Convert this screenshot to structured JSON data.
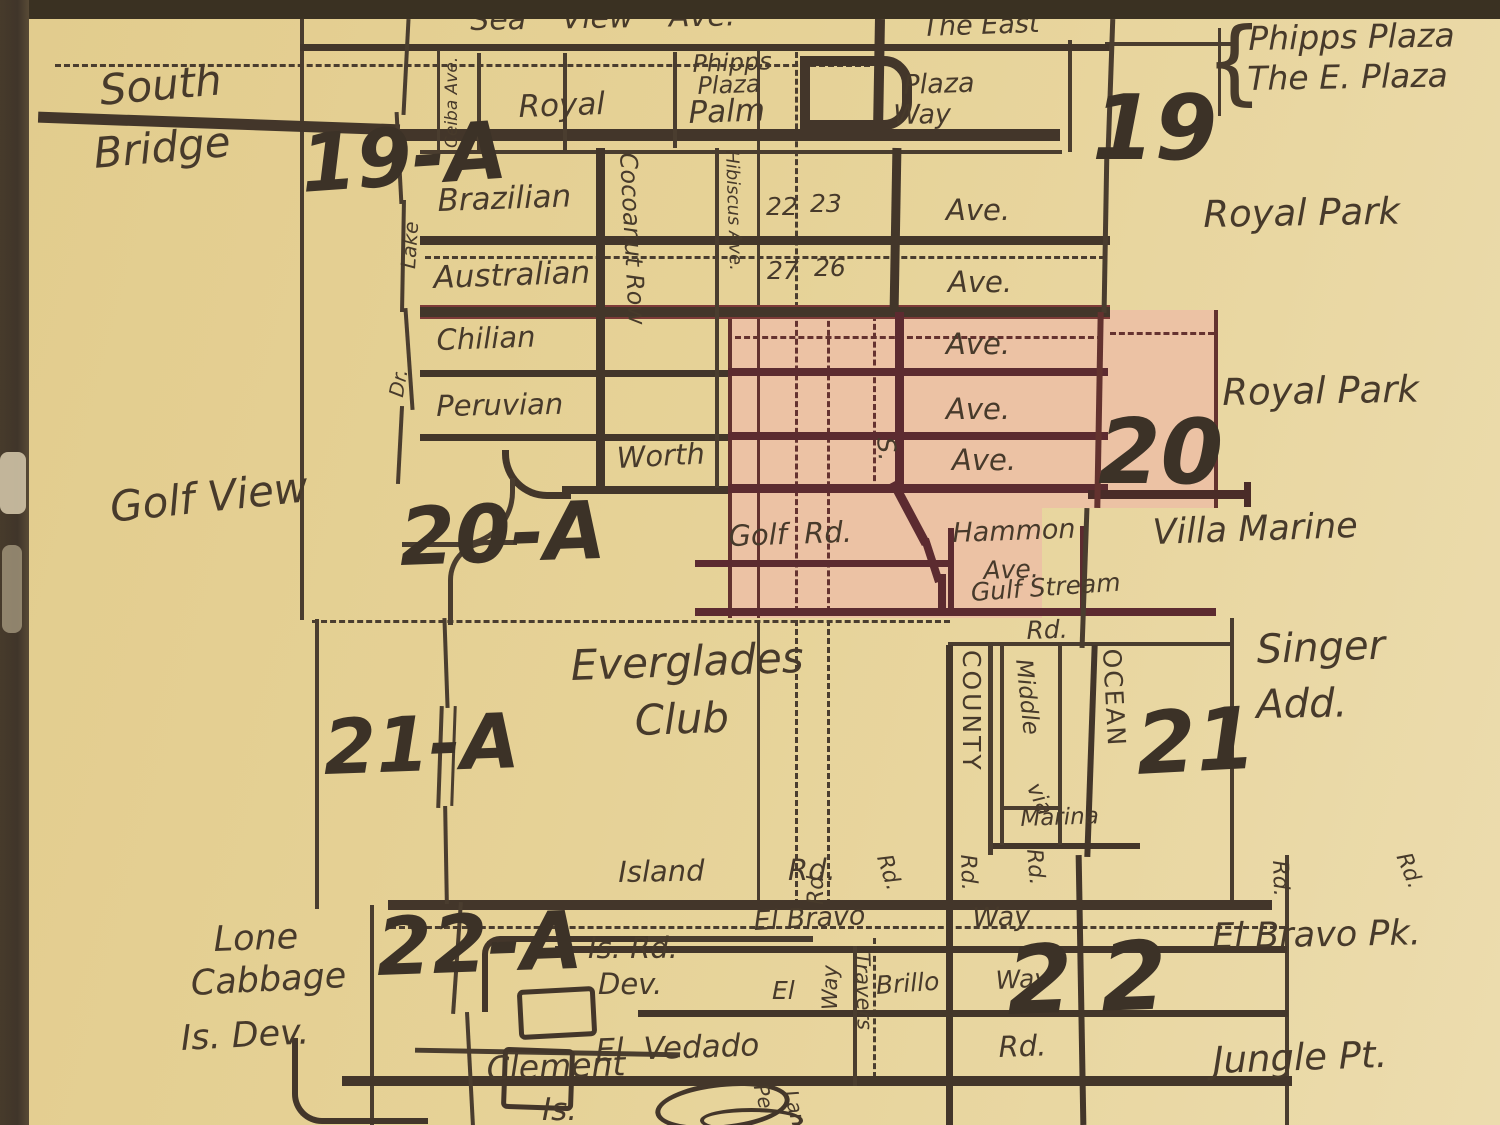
{
  "map_title": "Palm Beach plat map (Royal Park / Everglades Club district)",
  "colors": {
    "paper": "#e6d297",
    "ink": "#43362a",
    "highlight_pink": "#ecc2a4",
    "highlight_road_maroon": "#5c2b30",
    "frame": "#3a3122"
  },
  "labels": {
    "sea_view": "Sea View Ave.",
    "the_east": "The East",
    "brace": "{",
    "phipps_plaza_r1": "Phipps Plaza",
    "phipps_plaza_r2": "The E. Plaza",
    "south": "South",
    "bridge": "Bridge",
    "p19a": "19-A",
    "p19": "19",
    "royal": "Royal",
    "palm": "Palm",
    "phipps_sm1": "Phipps",
    "phipps_sm2": "Plaza",
    "plaza": "Plaza",
    "way": "Way",
    "ceiba": "Ceiba Ave.",
    "lake": "Lake",
    "dr": "Dr.",
    "brazilian": "Brazilian",
    "n22": "22",
    "n23": "23",
    "ave_braz": "Ave.",
    "australian": "Australian",
    "n27": "27",
    "n26": "26",
    "ave_aus": "Ave.",
    "chilian": "Chilian",
    "ave_chi": "Ave.",
    "peruvian": "Peruvian",
    "ave_per": "Ave.",
    "worth": "Worth",
    "s_cnty": "S.",
    "ave_worth": "Ave.",
    "p20": "20",
    "royal_park1": "Royal Park",
    "royal_park2": "Royal Park",
    "cocoanut": "Cocoanut Row",
    "hibiscus": "Hibiscus Ave.",
    "golf_view": "Golf View",
    "p20a": "20-A",
    "golf_rd": "Golf Rd.",
    "hammon": "Hammon",
    "hammon_ave": "Ave.",
    "gulf_stream": "Gulf Stream",
    "gulf_stream_rd": "Rd.",
    "villa_marine": "Villa Marine",
    "everglades": "Everglades",
    "club": "Club",
    "p21a": "21-A",
    "county": "COUNTY",
    "middle": "Middle",
    "via": "via",
    "ocean": "OCEAN",
    "p21": "21",
    "singer": "Singer",
    "add": "Add.",
    "marina": "Marina",
    "rd_county_s": "Rd.",
    "rd_marina_s": "Rd.",
    "island": "Island",
    "island_rd": "Rd.",
    "p22a": "22-A",
    "is_rd": "Is. Rd.",
    "dev": "Dev.",
    "el_bravo": "El Bravo",
    "el_bravo_way": "Way",
    "rd_v1": "Rd.",
    "rd_v2": "Rd.",
    "rd_v3": "Rd.",
    "rd_v4": "Rd.",
    "lone": "Lone",
    "cabbage": "Cabbage",
    "is_dev": "Is. Dev.",
    "el": "El",
    "way_v": "Way",
    "travers": "Travers",
    "brillo": "Brillo",
    "brillo_way": "Way",
    "p22": "22",
    "el_bravo_pk": "El Bravo Pk.",
    "el_vedado": "El Vedado",
    "el_vedado_rd": "Rd.",
    "clement": "Clement",
    "clement_is": "Is.",
    "jungle_pt": "Jungle Pt.",
    "pel": "Pel",
    "lan": "Lan"
  }
}
